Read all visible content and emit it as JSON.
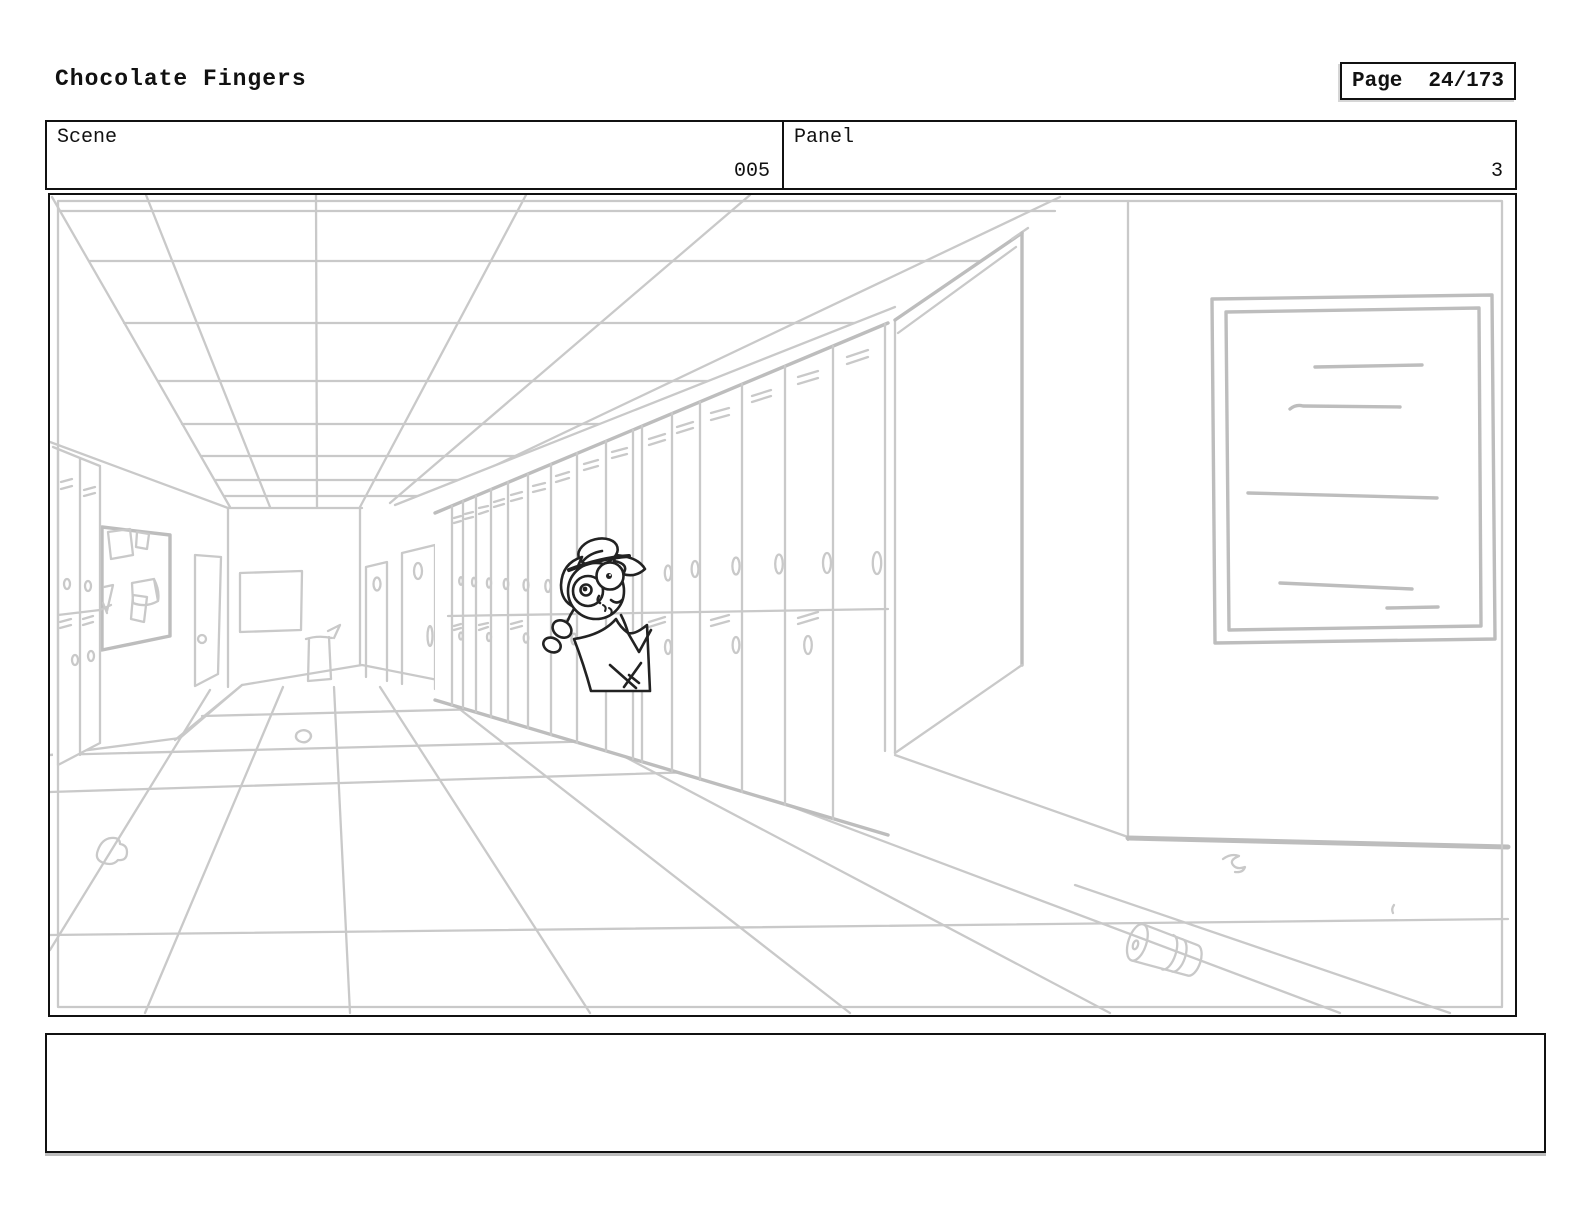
{
  "header": {
    "title": "Chocolate Fingers",
    "page": {
      "label": "Page",
      "value": "24/173"
    }
  },
  "info_row": {
    "scene": {
      "label": "Scene",
      "value": "005"
    },
    "panel": {
      "label": "Panel",
      "value": "3"
    }
  },
  "storyboard_panel": {
    "description": "Rough light-gray pencil sketch: one-point-perspective school hallway with ceiling tile grid, bank of lockers receding on the right with an open locker door, small lockers and a bulletin board with pinned papers plus a door on the left wall, two doors and a poster on the back wall with a drinking fountain, a large blank whiteboard on the near right wall, litter (paper wads, a soda can) on the tiled floor, and a worried girl with glasses and hair buns drawn in black ink peeking out from behind an open locker door."
  },
  "notes": {
    "value": ""
  },
  "colors": {
    "background": "#ffffff",
    "border": "#111111",
    "sketch_line": "#c9c9c9",
    "sketch_line_heavy": "#bdbdbd",
    "character_line": "#222222"
  }
}
